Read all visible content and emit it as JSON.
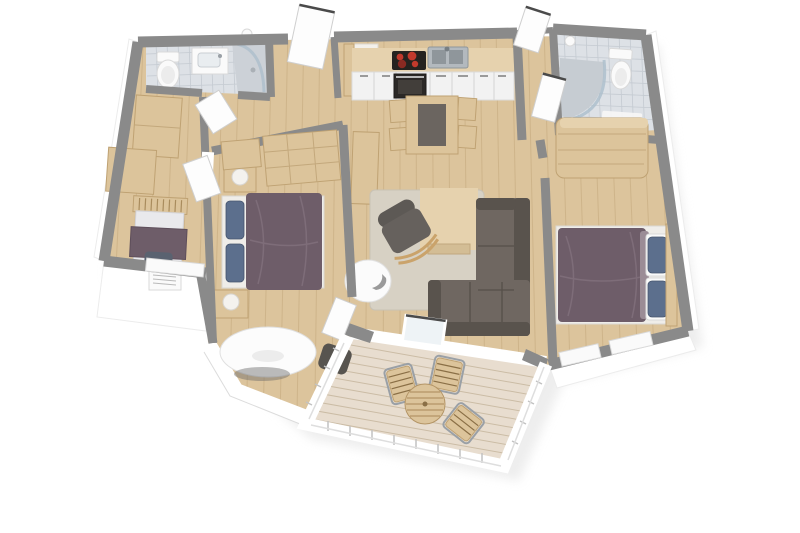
{
  "image": {
    "kind": "3d-floor-plan-render",
    "background": "#ffffff"
  },
  "colors": {
    "wall_top": "#8a8a8a",
    "wall_face": "#ffffff",
    "floor_wood": "#dcc49c",
    "floor_wood_line": "#c3a87c",
    "floor_wood_light": "#e6d2ae",
    "tile": "#dde1e6",
    "tile_line": "#c4cad1",
    "deck": "#e8ddcf",
    "deck_line": "#cbbca5",
    "rug": "#d7d1c4",
    "sofa": "#6f6761",
    "sofa_dark": "#59534d",
    "armchair": "#66615d",
    "bed_purple": "#6e5d69",
    "bed_purple_line": "#7e6d79",
    "pillow_blue": "#5c6f8d",
    "wood_furniture": "#dcc49b",
    "wood_furniture_dark": "#bfa273",
    "white_fixture": "#fafafa",
    "appliance_dark": "#26231f",
    "burner_red": "#c23a2c",
    "steel": "#b3b9be",
    "glass": "#aebfcc",
    "chair_dark": "#57544f",
    "shadow": "#e0e0e0"
  },
  "scene": {
    "rooms": [
      {
        "name": "bathroom-top-left",
        "floor": "tile",
        "furniture": [
          "toilet",
          "vanity-sink",
          "corner-shower"
        ]
      },
      {
        "name": "entry-hall",
        "floor": "wood",
        "furniture": [
          "entry-door",
          "storage-cabinets"
        ]
      },
      {
        "name": "kids-room",
        "floor": "wood",
        "furniture": [
          "single-bed",
          "radiator-window"
        ]
      },
      {
        "name": "bedroom-left",
        "floor": "wood",
        "furniture": [
          "wardrobes",
          "double-bed",
          "nightstand-lamps",
          "oval-table",
          "side-chair"
        ]
      },
      {
        "name": "kitchen-living-room",
        "floor": "wood",
        "furniture": [
          "kitchen-counter",
          "cooktop",
          "oven",
          "kitchen-sink",
          "dining-table",
          "dining-chairs",
          "sideboard-desk",
          "rug",
          "coffee-table",
          "corner-sofa",
          "armchair",
          "egg-chair",
          "sliding-door"
        ]
      },
      {
        "name": "bathroom-top-right",
        "floor": "tile",
        "furniture": [
          "curved-shower",
          "toilet",
          "bath-mat",
          "wardrobe"
        ]
      },
      {
        "name": "bedroom-right",
        "floor": "wood",
        "furniture": [
          "double-bed",
          "headboard",
          "windows"
        ]
      },
      {
        "name": "terrace-deck",
        "floor": "deck",
        "furniture": [
          "round-table",
          "deck-chairs",
          "railing"
        ]
      }
    ]
  }
}
